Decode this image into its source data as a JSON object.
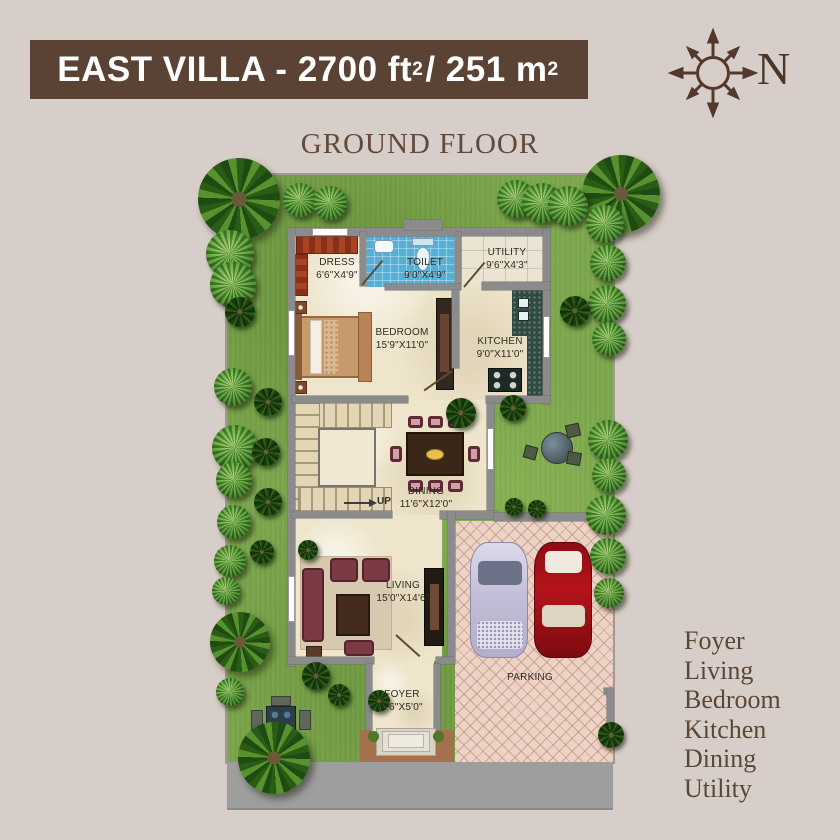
{
  "banner": {
    "part1": "EAST VILLA - 2700 ft",
    "sup1": "2",
    "part2": " / 251 m",
    "sup2": "2"
  },
  "subtitle": "GROUND FLOOR",
  "compass": {
    "label": "N"
  },
  "plan": {
    "rooms": [
      {
        "name": "DRESS",
        "dim": "6'6\"X4'9\""
      },
      {
        "name": "TOILET",
        "dim": "9'0\"X4'9\""
      },
      {
        "name": "UTILITY",
        "dim": "9'6\"X4'3\""
      },
      {
        "name": "BEDROOM",
        "dim": "15'9\"X11'0\""
      },
      {
        "name": "KITCHEN",
        "dim": "9'0\"X11'0\""
      },
      {
        "name": "DINING",
        "dim": "11'6\"X12'0\""
      },
      {
        "name": "LIVING",
        "dim": "15'0\"X14'6\""
      },
      {
        "name": "FOYER",
        "dim": "6'6\"X5'0\""
      }
    ],
    "parking_label": "PARKING",
    "stairs_label": "UP"
  },
  "legend": {
    "items": [
      "Foyer",
      "Living",
      "Bedroom",
      "Kitchen",
      "Dining",
      "Utility"
    ]
  },
  "colors": {
    "background": "#d8cec9",
    "banner": "#5a4334",
    "lawn": "#7ba54b",
    "wall": "#8b8b8b",
    "floor": "#eee5cc",
    "toilet_tile": "#55b0d8",
    "parking": "#ecd3c5",
    "road": "#9e9e9e",
    "legend_text": "#5c4736",
    "car_red": "#b5141b",
    "car_silver": "#c9c6da"
  }
}
